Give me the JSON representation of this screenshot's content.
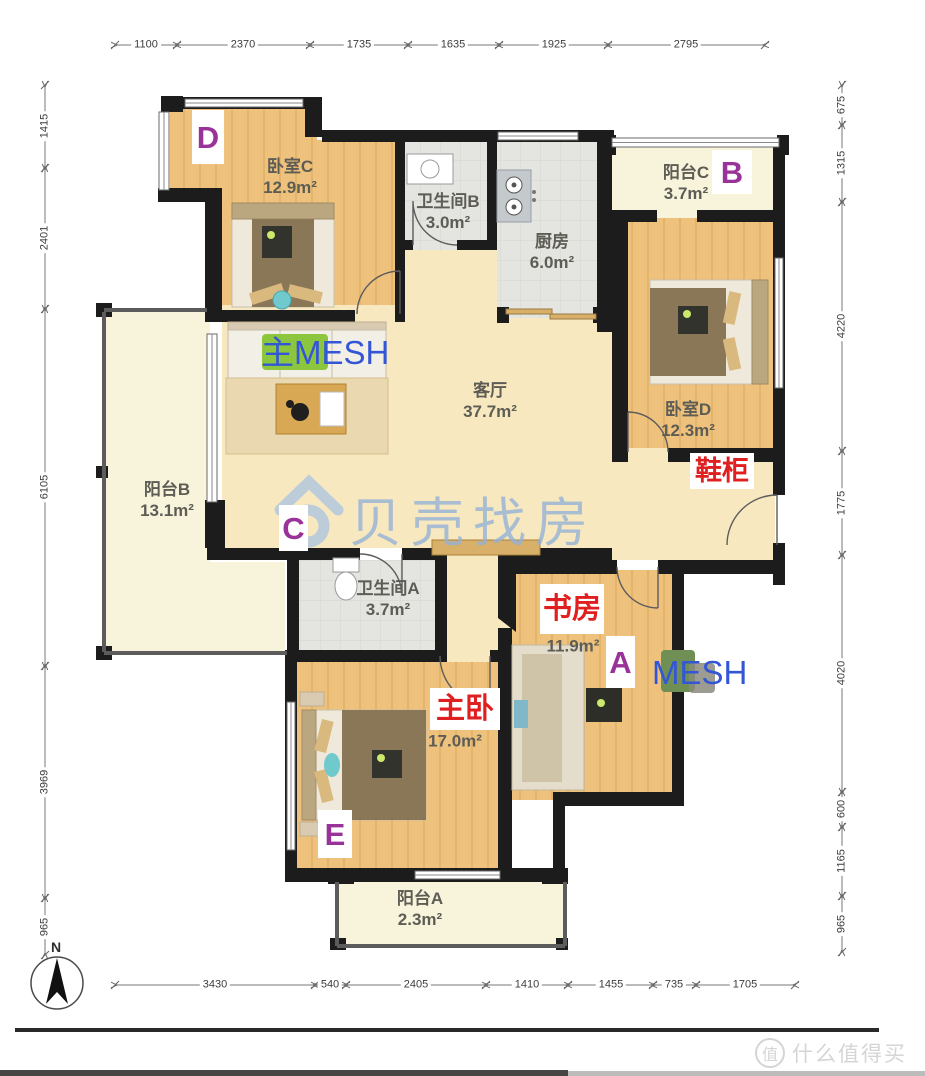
{
  "page": {
    "brand_watermark": "贝壳找房",
    "smzdm_badge": "值",
    "smzdm_text": "什么值得买",
    "north_label": "N"
  },
  "dimensions": {
    "top": [
      "1100",
      "2370",
      "1735",
      "1635",
      "1925",
      "2795"
    ],
    "bottom": [
      "3430",
      "540",
      "2405",
      "1410",
      "1455",
      "735",
      "1705"
    ],
    "left": [
      "1415",
      "2401",
      "6105",
      "3969",
      "965"
    ],
    "right": [
      "675",
      "1315",
      "4220",
      "1775",
      "4020",
      "600",
      "1165",
      "965"
    ]
  },
  "rooms": [
    {
      "name": "卧室C",
      "area": "12.9m²"
    },
    {
      "name": "卫生间B",
      "area": "3.0m²"
    },
    {
      "name": "厨房",
      "area": "6.0m²"
    },
    {
      "name": "阳台C",
      "area": "3.7m²"
    },
    {
      "name": "卧室D",
      "area": "12.3m²"
    },
    {
      "name": "客厅",
      "area": "37.7m²"
    },
    {
      "name": "阳台B",
      "area": "13.1m²"
    },
    {
      "name": "卫生间A",
      "area": "3.7m²"
    },
    {
      "name": "书房",
      "area": "11.9m²"
    },
    {
      "name": "主卧",
      "area": "17.0m²"
    },
    {
      "name": "阳台A",
      "area": "2.3m²"
    }
  ],
  "annotations": {
    "mesh_main": "主MESH",
    "mesh_node": "MESH",
    "shoe_cabinet": "鞋柜",
    "points": {
      "a": "A",
      "b": "B",
      "c": "C",
      "d": "D",
      "e": "E"
    }
  },
  "colors": {
    "wall": "#1c1c1c",
    "wood": "#eec27c",
    "living": "#f7e8c0",
    "balcony": "#f8f4dc",
    "tile": "#e4e4e0",
    "point_purple": "#993399",
    "annotation_red": "#e02020",
    "mesh_blue": "#3356d6",
    "mesh_green": "#8cc63f",
    "brand_blue": "#a9c3e2"
  }
}
